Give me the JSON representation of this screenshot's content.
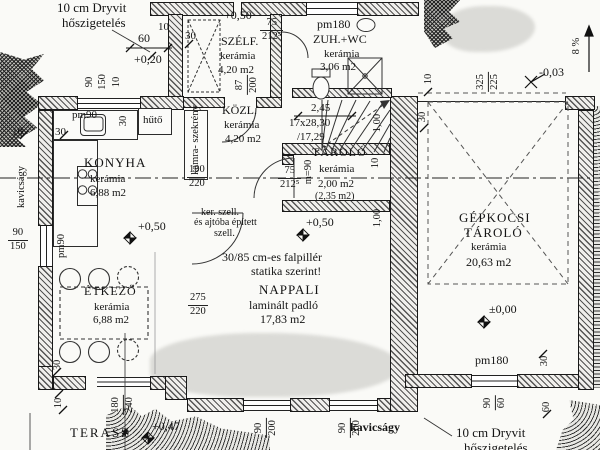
{
  "notes": {
    "dryvit_1": "10 cm Dryvit",
    "dryvit_2": "hőszigetelés",
    "gravel": "kavicságy",
    "slope": "8 %",
    "pillar_1": "30/85 cm-es falpillér",
    "pillar_2": "statika szerint!",
    "vent_1": "ker. szell.",
    "vent_2": "és ajtóba épített",
    "vent_3": "szell."
  },
  "rooms": {
    "konyha": {
      "name": "KONYHA",
      "finish": "kerámia",
      "area": "6,88 m2"
    },
    "etkezo": {
      "name": "ÉTKEZŐ",
      "finish": "kerámia",
      "area": "6,88 m2"
    },
    "nappali": {
      "name": "NAPPALI",
      "finish": "laminált padló",
      "area": "17,83 m2"
    },
    "kozl": {
      "name": "KÖZL.",
      "finish": "kerámia",
      "area": "4,20 m2"
    },
    "szelf": {
      "name": "SZÉLF.",
      "finish": "kerámia",
      "area": "4,20 m2"
    },
    "zuhwc": {
      "name": "ZUH.+WC",
      "finish": "kerámia",
      "area": "3,06 m2"
    },
    "tarolo": {
      "name": "TÁROLÓ",
      "finish": "kerámia",
      "area": "2,00 m2",
      "area_alt": "(2,35 m2)"
    },
    "garage": {
      "name_1": "GÉPKOCSI",
      "name_2": "TÁROLÓ",
      "finish": "kerámia",
      "area": "20,63 m2"
    },
    "terasz": {
      "name": "TERASZ"
    }
  },
  "fixtures": {
    "fridge": "hűtő",
    "pantry_1": "kamra-",
    "pantry_2": "szekrény",
    "parapet": "m=90",
    "plant": "✱"
  },
  "levels": {
    "half": "+0,50",
    "plus020": "+0,20",
    "minus003": "-0,03",
    "zero": "±0,00",
    "plus047": "+0,47"
  },
  "stair": {
    "width": "2,45",
    "steps": "17x28,30",
    "rise": "/17,29"
  },
  "openings": {
    "pm90": "pm90",
    "pm180": "pm180",
    "d75_n": "75",
    "d75_d": "212⁵",
    "d87_n": "87",
    "d87_d": "200",
    "garage_n": "325",
    "garage_d": "225",
    "lintel_n": "100",
    "lintel_d": "220",
    "w275_n": "275",
    "w275_d": "220",
    "w90200_n": "90",
    "w90200_d": "200",
    "terr_n": "180",
    "terr_d": "240",
    "w9060_n": "90",
    "w9060_d": "60",
    "w90150_n": "90",
    "w90150_d": "150"
  },
  "dims": {
    "d10": "10",
    "d30": "30",
    "d60": "60",
    "d90": "90",
    "d150": "150",
    "d100": "1,00"
  }
}
